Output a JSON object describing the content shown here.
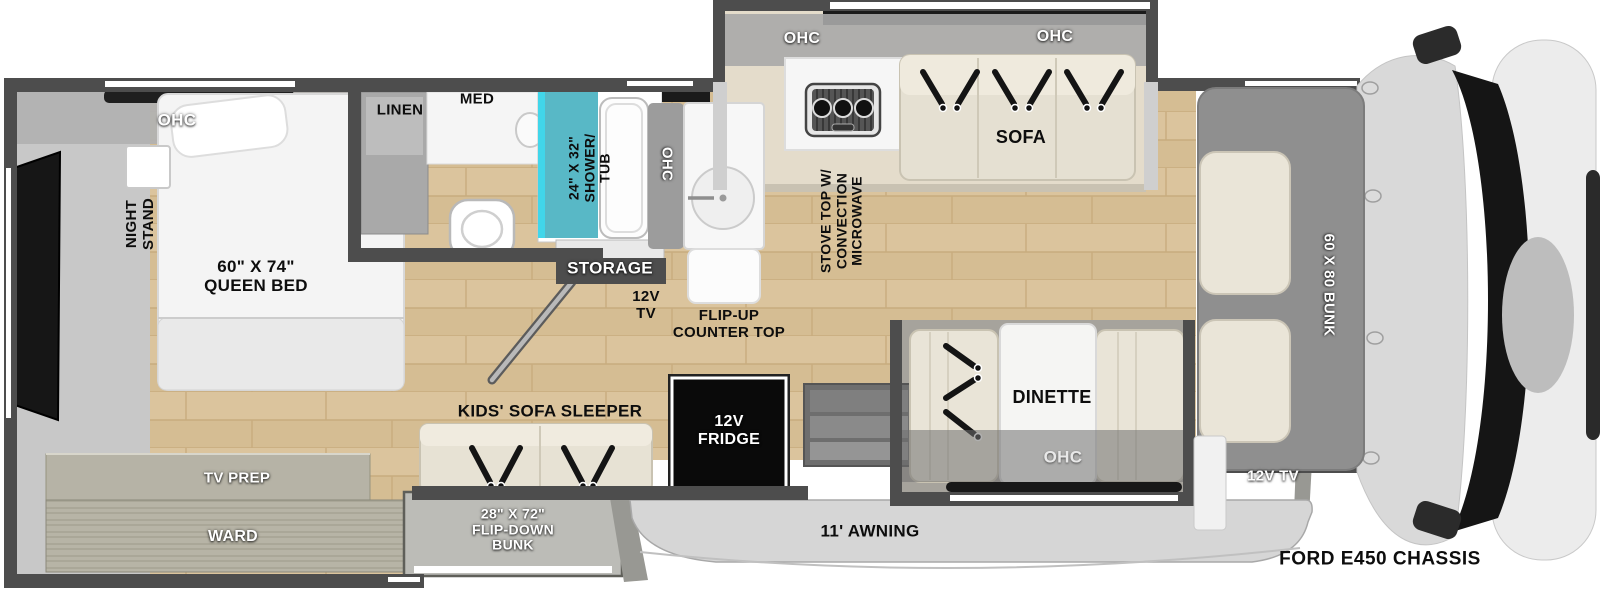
{
  "title": "RV floor plan - Ford E450 Chassis class C motorhome",
  "colors": {
    "wall": "#4d4d4d",
    "wood_floor": "#dbc49d",
    "slideout_floor": "#e6dfd0",
    "furniture_beige": "#e9e4d7",
    "shower_teal": "#58b8c6",
    "shower_accent_cyan": "#41d6ea",
    "fridge_black": "#0d0d0d",
    "awning_gray": "#d6d6d6",
    "cabover_bunk_gray": "#8f8f8f",
    "cab_body_gray": "#dcdcdc",
    "label_white": "#ffffff",
    "label_black": "#0d0d0d"
  },
  "labels": {
    "bedroom_ohc": "OHC",
    "night_stand": "NIGHT\nSTAND",
    "queen_bed": "60\" X 74\"\nQUEEN BED",
    "tv_prep": "TV PREP",
    "ward": "WARD",
    "linen": "LINEN",
    "med": "MED",
    "shower_tub": "24\" X 32\"\nSHOWER/\nTUB",
    "storage": "STORAGE",
    "hall_tv": "12V\nTV",
    "cabinet_ohc": "OHC",
    "flip_up_counter": "FLIP-UP\nCOUNTER TOP",
    "stove": "STOVE TOP W/\nCONVECTION\nMICROWAVE",
    "kitchen_ohc": "OHC",
    "sofa_ohc": "OHC",
    "sofa": "SOFA",
    "dinette": "DINETTE",
    "dinette_ohc": "OHC",
    "kids_sofa_sleeper": "KIDS' SOFA SLEEPER",
    "flip_down_bunk": "28\" X 72\"\nFLIP-DOWN\nBUNK",
    "fridge": "12V\nFRIDGE",
    "awning": "11' AWNING",
    "cabover_bunk": "60 X 80 BUNK",
    "cab_tv": "12V TV",
    "chassis": "FORD E450 CHASSIS"
  }
}
